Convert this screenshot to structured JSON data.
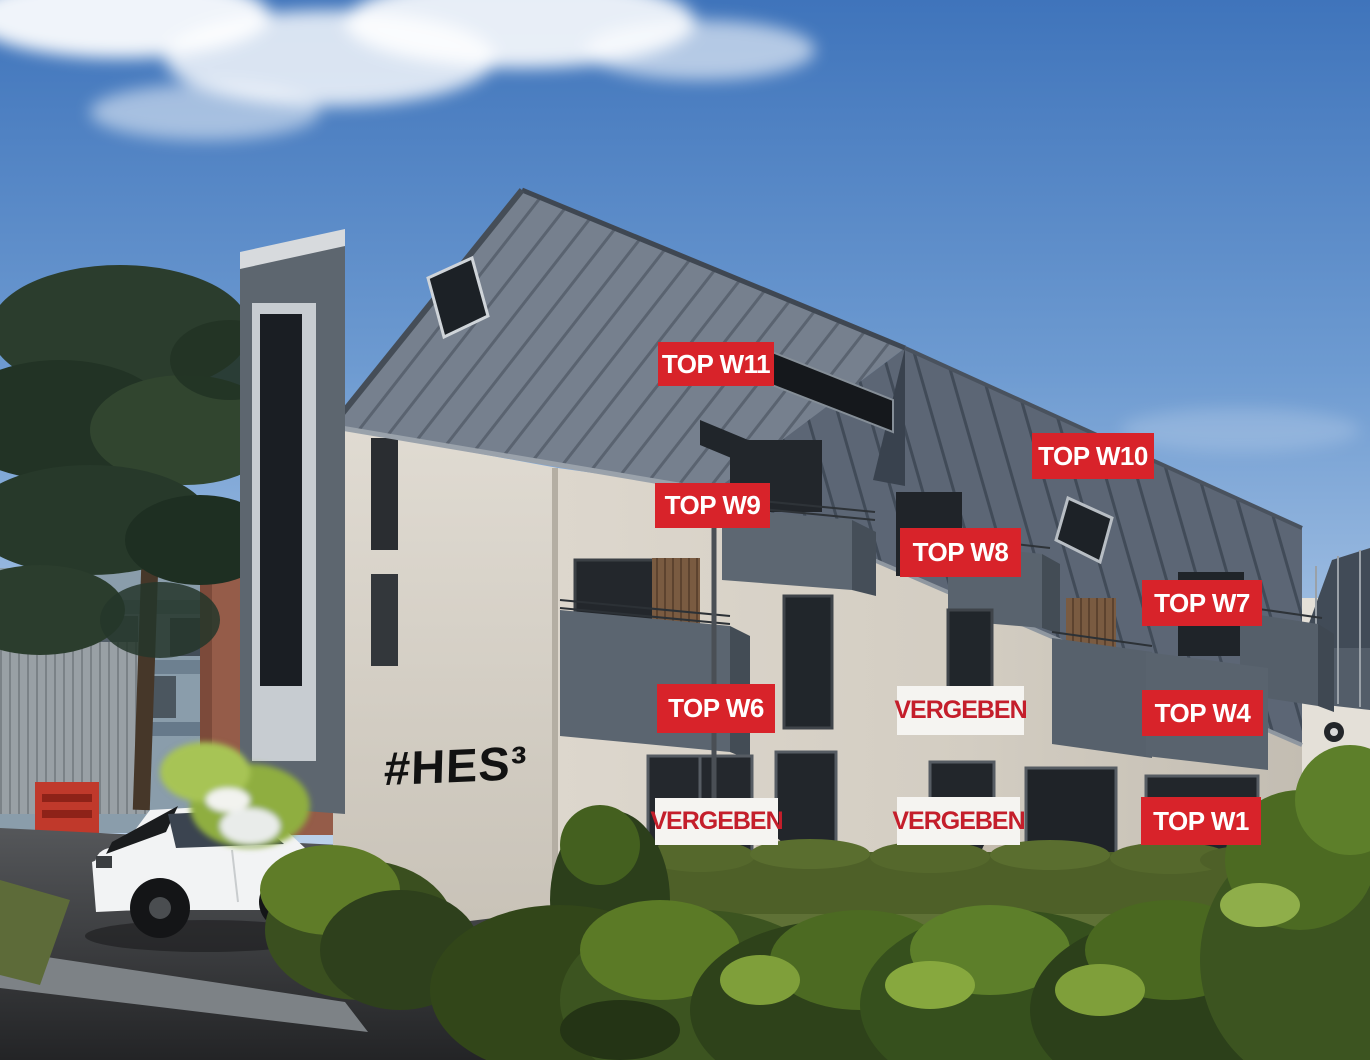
{
  "overlay": {
    "logo": "#HES³",
    "labels": [
      {
        "id": "top-w11",
        "text": "TOP W11",
        "status": "available"
      },
      {
        "id": "top-w10",
        "text": "TOP W10",
        "status": "available"
      },
      {
        "id": "top-w9",
        "text": "TOP W9",
        "status": "available"
      },
      {
        "id": "top-w8",
        "text": "TOP W8",
        "status": "available"
      },
      {
        "id": "top-w7",
        "text": "TOP W7",
        "status": "available"
      },
      {
        "id": "top-w6",
        "text": "TOP W6",
        "status": "available"
      },
      {
        "id": "vergeben-upper-mid",
        "text": "VERGEBEN",
        "status": "sold"
      },
      {
        "id": "top-w4",
        "text": "TOP W4",
        "status": "available"
      },
      {
        "id": "vergeben-ground-left",
        "text": "VERGEBEN",
        "status": "sold"
      },
      {
        "id": "vergeben-ground-mid",
        "text": "VERGEBEN",
        "status": "sold"
      },
      {
        "id": "top-w1",
        "text": "TOP W1",
        "status": "available"
      }
    ],
    "colors": {
      "available_bg": "#d8232a",
      "available_text": "#ffffff",
      "sold_bg": "#f5f4f1",
      "sold_text": "#c41e2b",
      "logo_text": "#121212"
    }
  },
  "scene_colors": {
    "sky_top": "#3f74bb",
    "sky_horizon": "#c8daee",
    "roof_metal": "#6e7987",
    "facade_stucco": "#d8d2c8",
    "balcony_box": "#5b6570",
    "hedge_green": "#6f8c33",
    "asphalt": "#3c3e40",
    "car_body": "#f2f3f4"
  }
}
